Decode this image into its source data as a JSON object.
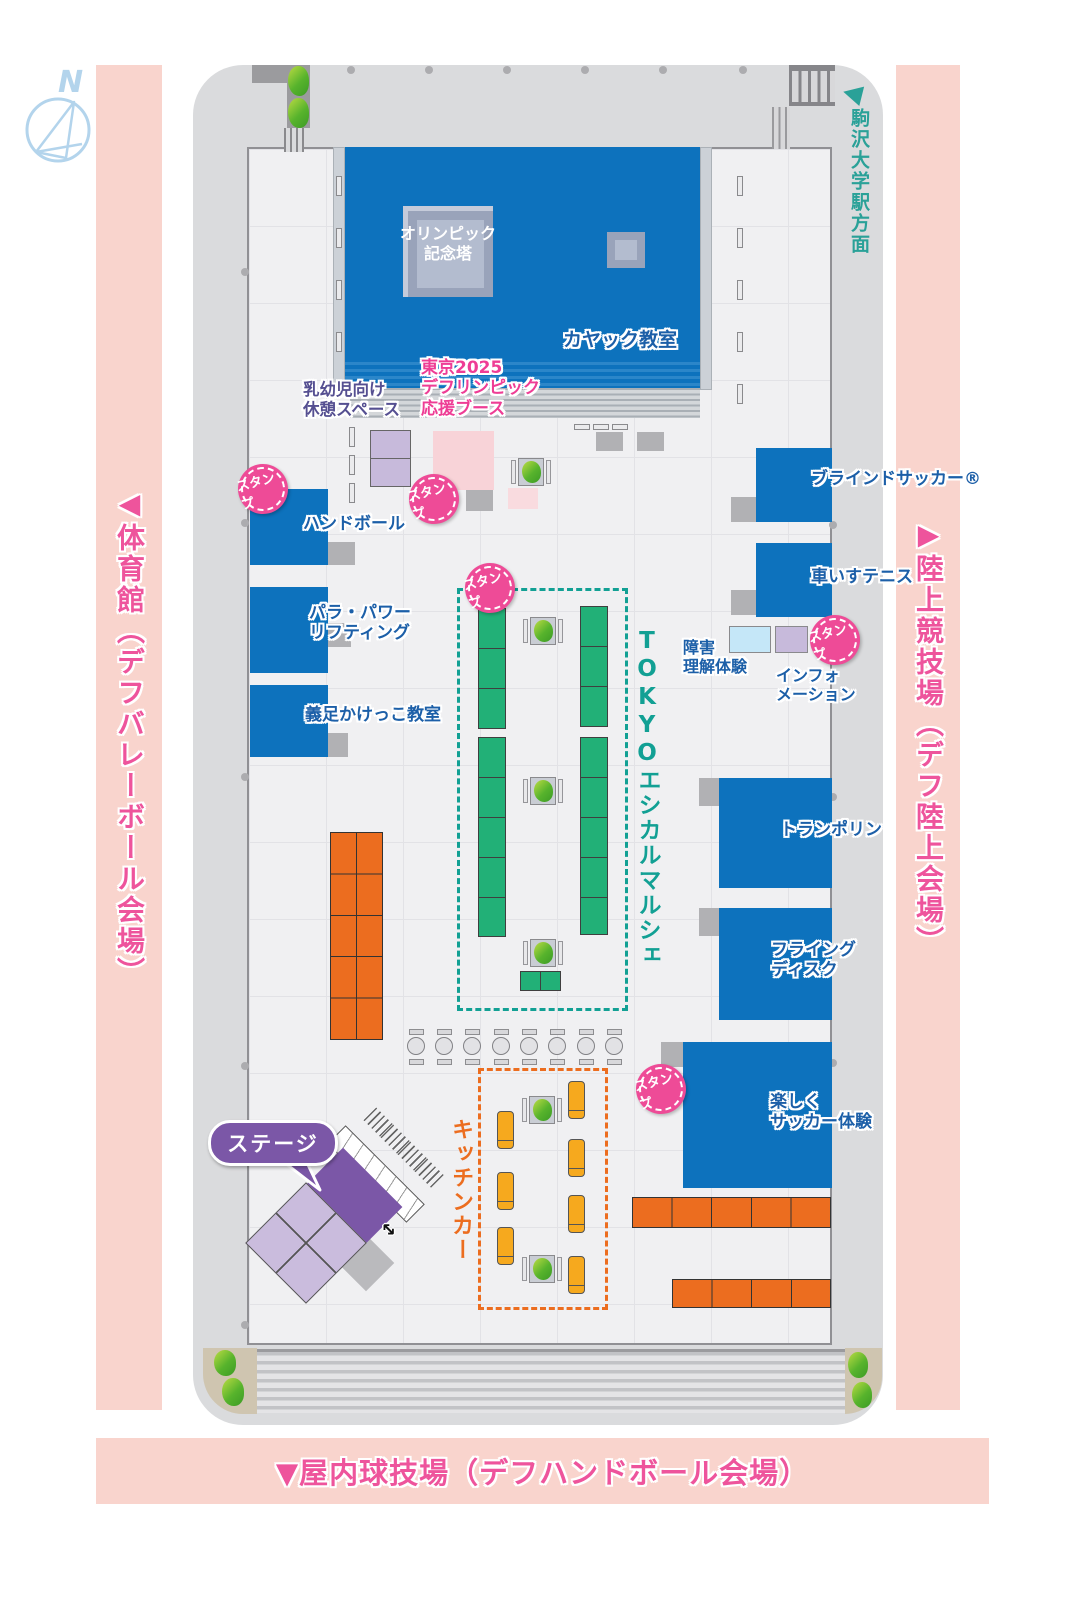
{
  "labels": {
    "compass_n": "N",
    "station": "駒沢大学駅方面",
    "left_venue": "◀体育館（デフバレーボール会場）",
    "right_venue": "▶陸上競技場（デフ陸上会場）",
    "bottom_venue": "▼屋内球技場（デフハンドボール会場）",
    "tower_line1": "オリンピック",
    "tower_line2": "記念塔",
    "kayak": "カヤック教室",
    "rest_line1": "乳幼児向け",
    "rest_line2": "休憩スペース",
    "support_line1": "東京2025",
    "support_line2": "デフリンピック",
    "support_line3": "応援ブース",
    "handball": "ハンドボール",
    "para_line1": "パラ・パワー",
    "para_line2": "リフティング",
    "gisoku": "義足かけっこ教室",
    "blind_soccer": "ブラインドサッカー®",
    "wheelchair_tennis": "車いすテニス",
    "disability_line1": "障害",
    "disability_line2": "理解体験",
    "info_line1": "インフォ",
    "info_line2": "メーション",
    "trampoline": "トランポリン",
    "flying_line1": "フライング",
    "flying_line2": "ディスク",
    "fun_soccer_line1": "楽しく",
    "fun_soccer_line2": "サッカー体験",
    "marche": "TOKYOエシカルマルシェ",
    "kitchen": "キッチンカー",
    "stage": "ステージ",
    "stamp": "スタンプ"
  },
  "colors": {
    "pink_bar": "#f9d4cd",
    "pink_text": "#ee549c",
    "teal": "#12a094",
    "station_teal": "#2aa198",
    "pond_blue": "#0d72bd",
    "booth_blue": "#0d72bd",
    "booth_label_blue": "#1c5fa8",
    "green_booth": "#22b077",
    "orange": "#ec6d1f",
    "kitchen_car_yellow": "#f6a91e",
    "stage_purple": "#7b57a7",
    "light_purple": "#c7badb",
    "support_pink": "#f8d3d8",
    "disability_lightblue": "#c5e7f8",
    "stamp_pink": "#ee4b97",
    "support_label_pink": "#ee3d95",
    "rest_label_purple": "#554f91"
  }
}
